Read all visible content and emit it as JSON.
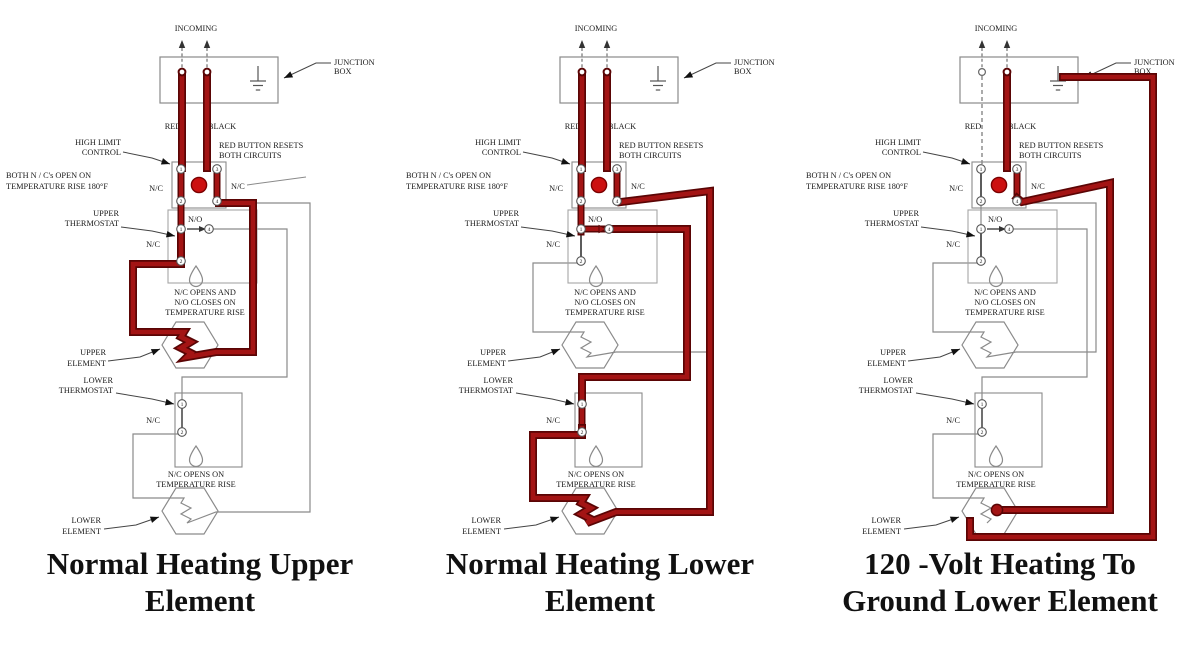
{
  "colors": {
    "energized_wire": "#a31414",
    "energized_outline": "#5a0505",
    "reset_button": "#cc1111",
    "line_gray": "#8a8a8a",
    "contact_dark": "#333333"
  },
  "labels": {
    "incoming": "INCOMING",
    "junction_box_1": "JUNCTION",
    "junction_box_2": "BOX",
    "red": "RED",
    "black": "BLACK",
    "high_limit_1": "HIGH LIMIT",
    "high_limit_2": "CONTROL",
    "red_button_1": "RED BUTTON RESETS",
    "red_button_2": "BOTH CIRCUITS",
    "both_nc_1": "BOTH N / C's OPEN ON",
    "both_nc_2": "TEMPERATURE RISE 180°F",
    "nc": "N/C",
    "no": "N/O",
    "upper_thermostat_1": "UPPER",
    "upper_thermostat_2": "THERMOSTAT",
    "upper_note_1": "N/C OPENS AND",
    "upper_note_2": "N/O CLOSES ON",
    "upper_note_3": "TEMPERATURE RISE",
    "upper_element_1": "UPPER",
    "upper_element_2": "ELEMENT",
    "lower_thermostat_1": "LOWER",
    "lower_thermostat_2": "THERMOSTAT",
    "lower_note_1": "N/C OPENS ON",
    "lower_note_2": "TEMPERATURE RISE",
    "lower_element_1": "LOWER",
    "lower_element_2": "ELEMENT",
    "terminals": {
      "t1": "1",
      "t2": "2",
      "t3": "3",
      "t4": "4"
    }
  },
  "diagrams": [
    {
      "id": "normal-heating-upper-element",
      "caption_1": "Normal Heating Upper",
      "caption_2": "Element"
    },
    {
      "id": "normal-heating-lower-element",
      "caption_1": "Normal Heating Lower",
      "caption_2": "Element"
    },
    {
      "id": "120-volt-heating-to-ground-lower-element",
      "caption_1": "120 -Volt Heating To",
      "caption_2": "Ground Lower Element"
    }
  ]
}
